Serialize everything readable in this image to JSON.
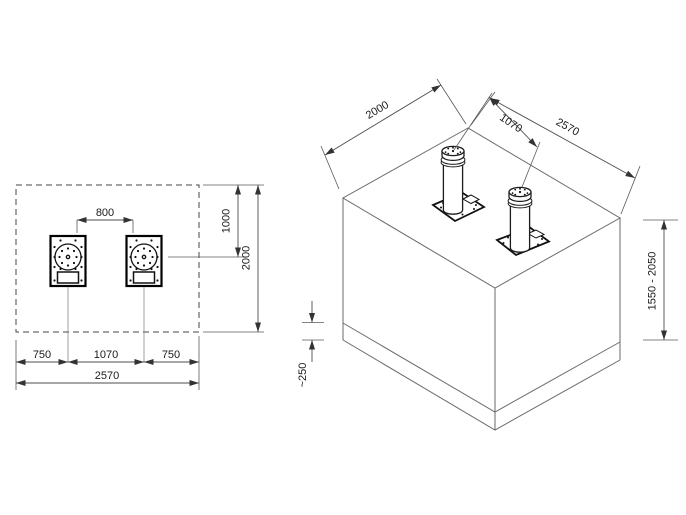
{
  "colors": {
    "background": "#ffffff",
    "line": "#4d4d4d",
    "dark_line": "#111111",
    "text": "#1a1a1a"
  },
  "plan": {
    "dim_clear_gap": "800",
    "dim_half_depth": "1000",
    "dim_depth": "2000",
    "dim_margin_left": "750",
    "dim_spacing": "1070",
    "dim_margin_right": "750",
    "dim_width": "2570"
  },
  "iso": {
    "dim_depth": "2000",
    "dim_spacing": "1070",
    "dim_width": "2570",
    "dim_height_range": "1550 - 2050",
    "dim_base_layer": "~250"
  }
}
